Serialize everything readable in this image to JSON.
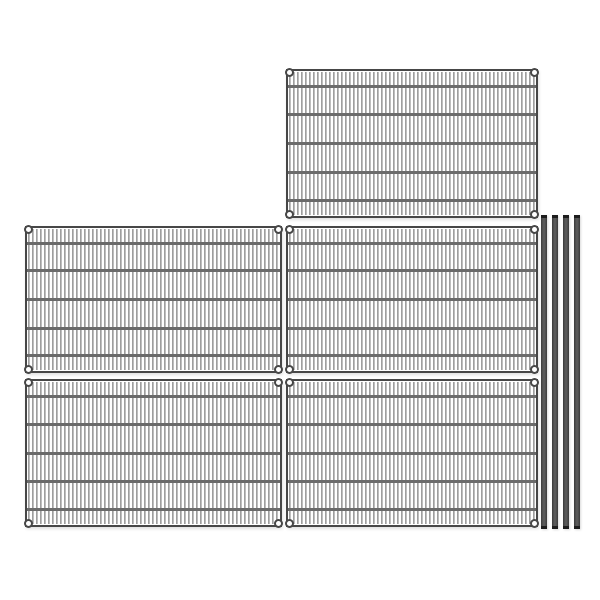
{
  "image": {
    "description": "Product photo of a wire shelving kit: five chrome wire mesh shelf panels shown flat and four dark shelving posts standing on the right, on a plain white background",
    "background": "#ffffff",
    "colors": {
      "background": "#ffffff",
      "frame": "#474747",
      "horizontal_wire": "#6b6b6b",
      "vertical_wire": "#9e9e9e",
      "vertical_wire_highlight": "#dedede",
      "ring_fill": "#ffffff",
      "ring_stroke": "#474747",
      "pole_body": "#5a5a5a",
      "pole_edge": "#3a3a3a",
      "pole_cap": "#1d1d1d"
    },
    "shelf_panel_count": 5,
    "post_count": 4,
    "panels": [
      {
        "id": "top",
        "left": 286,
        "top": 69,
        "width": 252,
        "height": 149
      },
      {
        "id": "middle-left",
        "left": 25,
        "top": 226,
        "width": 257,
        "height": 147
      },
      {
        "id": "middle-right",
        "left": 286,
        "top": 226,
        "width": 252,
        "height": 147
      },
      {
        "id": "bottom-left",
        "left": 25,
        "top": 379,
        "width": 257,
        "height": 148
      },
      {
        "id": "bottom-right",
        "left": 286,
        "top": 379,
        "width": 252,
        "height": 148
      }
    ],
    "horizontal_wire_fractions": [
      0.105,
      0.3,
      0.5,
      0.7,
      0.895
    ],
    "vertical_wire_period_px": 4,
    "corner_rings_per_panel": 4,
    "posts": {
      "xs": [
        541,
        552,
        563,
        574
      ],
      "top": 215,
      "height": 314,
      "width": 6,
      "cap_height": 3
    }
  }
}
